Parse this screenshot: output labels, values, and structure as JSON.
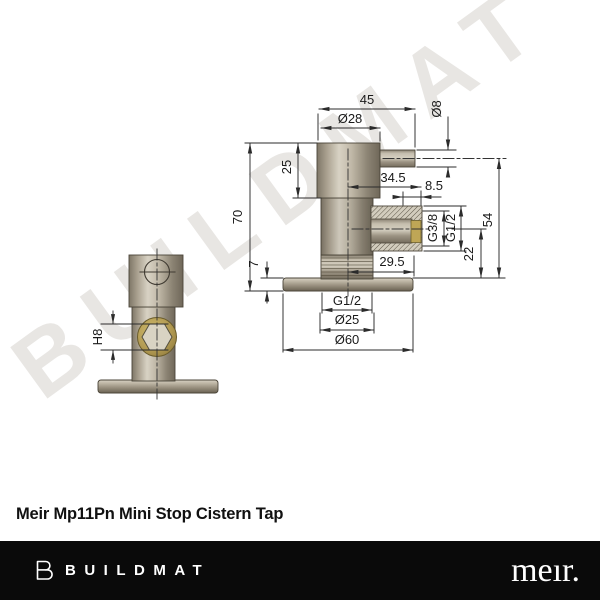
{
  "watermark": {
    "text": "BUILDMAT",
    "color": "#e8e6e3"
  },
  "drawing": {
    "front_view": {
      "hex_socket": "H8"
    },
    "side_view": {
      "overall_width": "45",
      "body_diameter": "Ø28",
      "spigot_diameter": "Ø8",
      "upper_body_height": "25",
      "outlet_reach": "34.5",
      "outlet_thread_length": "8.5",
      "overall_height": "70",
      "flange_thickness": "7",
      "outlet_thread_small": "G3/8",
      "outlet_thread_large": "G1/2",
      "outlet_height_above_base": "22",
      "spigot_height_above_base": "54",
      "outlet_face_offset": "29.5",
      "inlet_thread": "G1/2",
      "inlet_diameter": "Ø25",
      "flange_diameter": "Ø60"
    }
  },
  "product": {
    "title": "Meir Mp11Pn Mini Stop Cistern Tap"
  },
  "footer": {
    "brand_name": "BUILDMAT",
    "partner_logo": "meır."
  },
  "colors": {
    "metal_light": "#d8d2c4",
    "metal_dark": "#6f6759",
    "brass": "#b29a52",
    "line": "#2b2b2b",
    "footer_background": "#0a0a0a",
    "watermark": "#e8e6e3"
  }
}
